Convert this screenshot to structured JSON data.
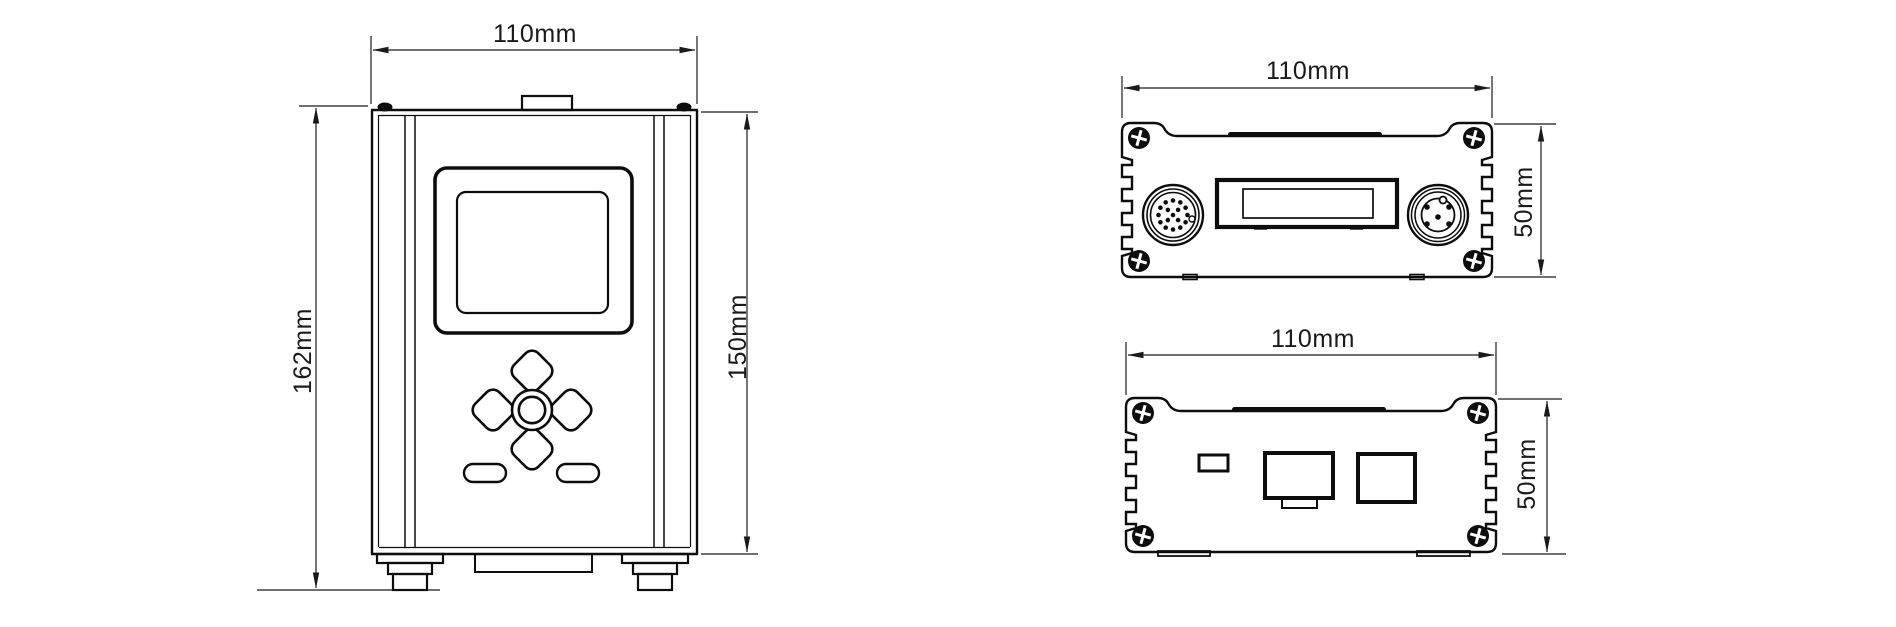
{
  "drawing": {
    "background_color": "#ffffff",
    "line_color": "#0d0d0d",
    "dimension_color": "#1a1a1a",
    "views": {
      "front": {
        "width_label": "110mm",
        "overall_height_label": "162mm",
        "body_height_label": "150mm"
      },
      "rear_connector_panel": {
        "width_label": "110mm",
        "height_label": "50mm"
      },
      "rear_port_panel": {
        "width_label": "110mm",
        "height_label": "50mm"
      }
    }
  }
}
